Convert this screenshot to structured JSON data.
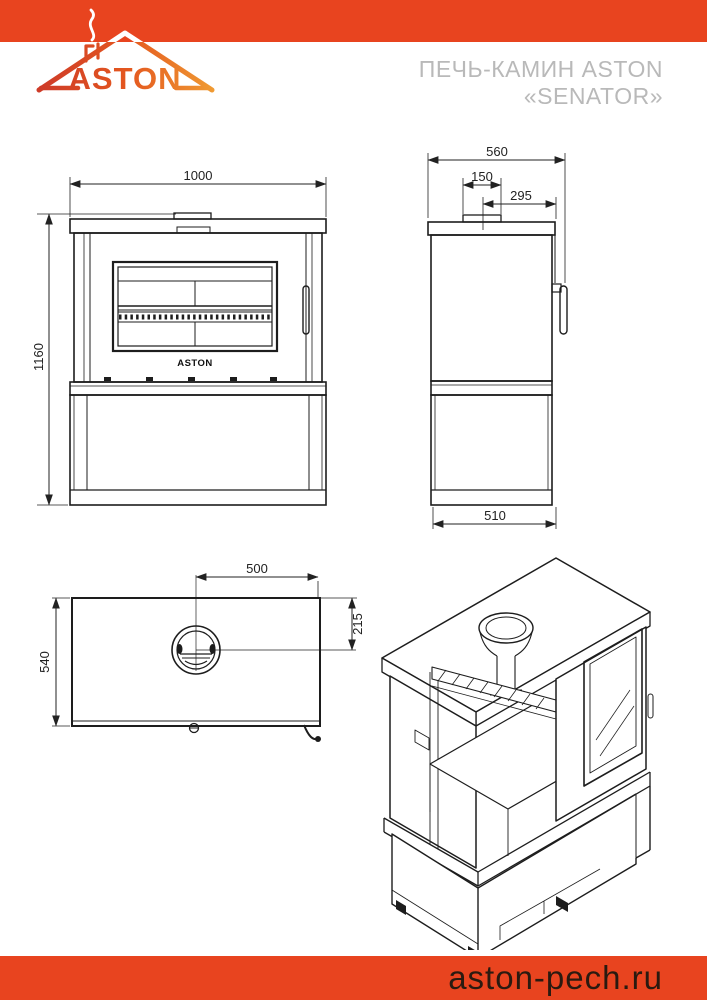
{
  "brand": {
    "logo_text": "ASTON"
  },
  "header": {
    "title_line1": "ПЕЧЬ-КАМИН ASTON",
    "title_line2": "«SENATOR»"
  },
  "footer": {
    "site_url": "aston-pech.ru"
  },
  "colors": {
    "accent": "#E8441F",
    "title_gray": "#B9B9B9",
    "line": "#1D1D1D",
    "footer_text": "#2A1A10"
  },
  "views": {
    "front": {
      "width_mm": "1000",
      "height_mm": "1160",
      "door_brand": "ASTON"
    },
    "side": {
      "depth_mm": "560",
      "flue_collar_mm": "150",
      "flue_center_to_front_mm": "295",
      "base_depth_mm": "510"
    },
    "top": {
      "flue_center_offset_mm": "500",
      "flue_center_depth_mm": "215",
      "depth_mm": "540"
    }
  }
}
